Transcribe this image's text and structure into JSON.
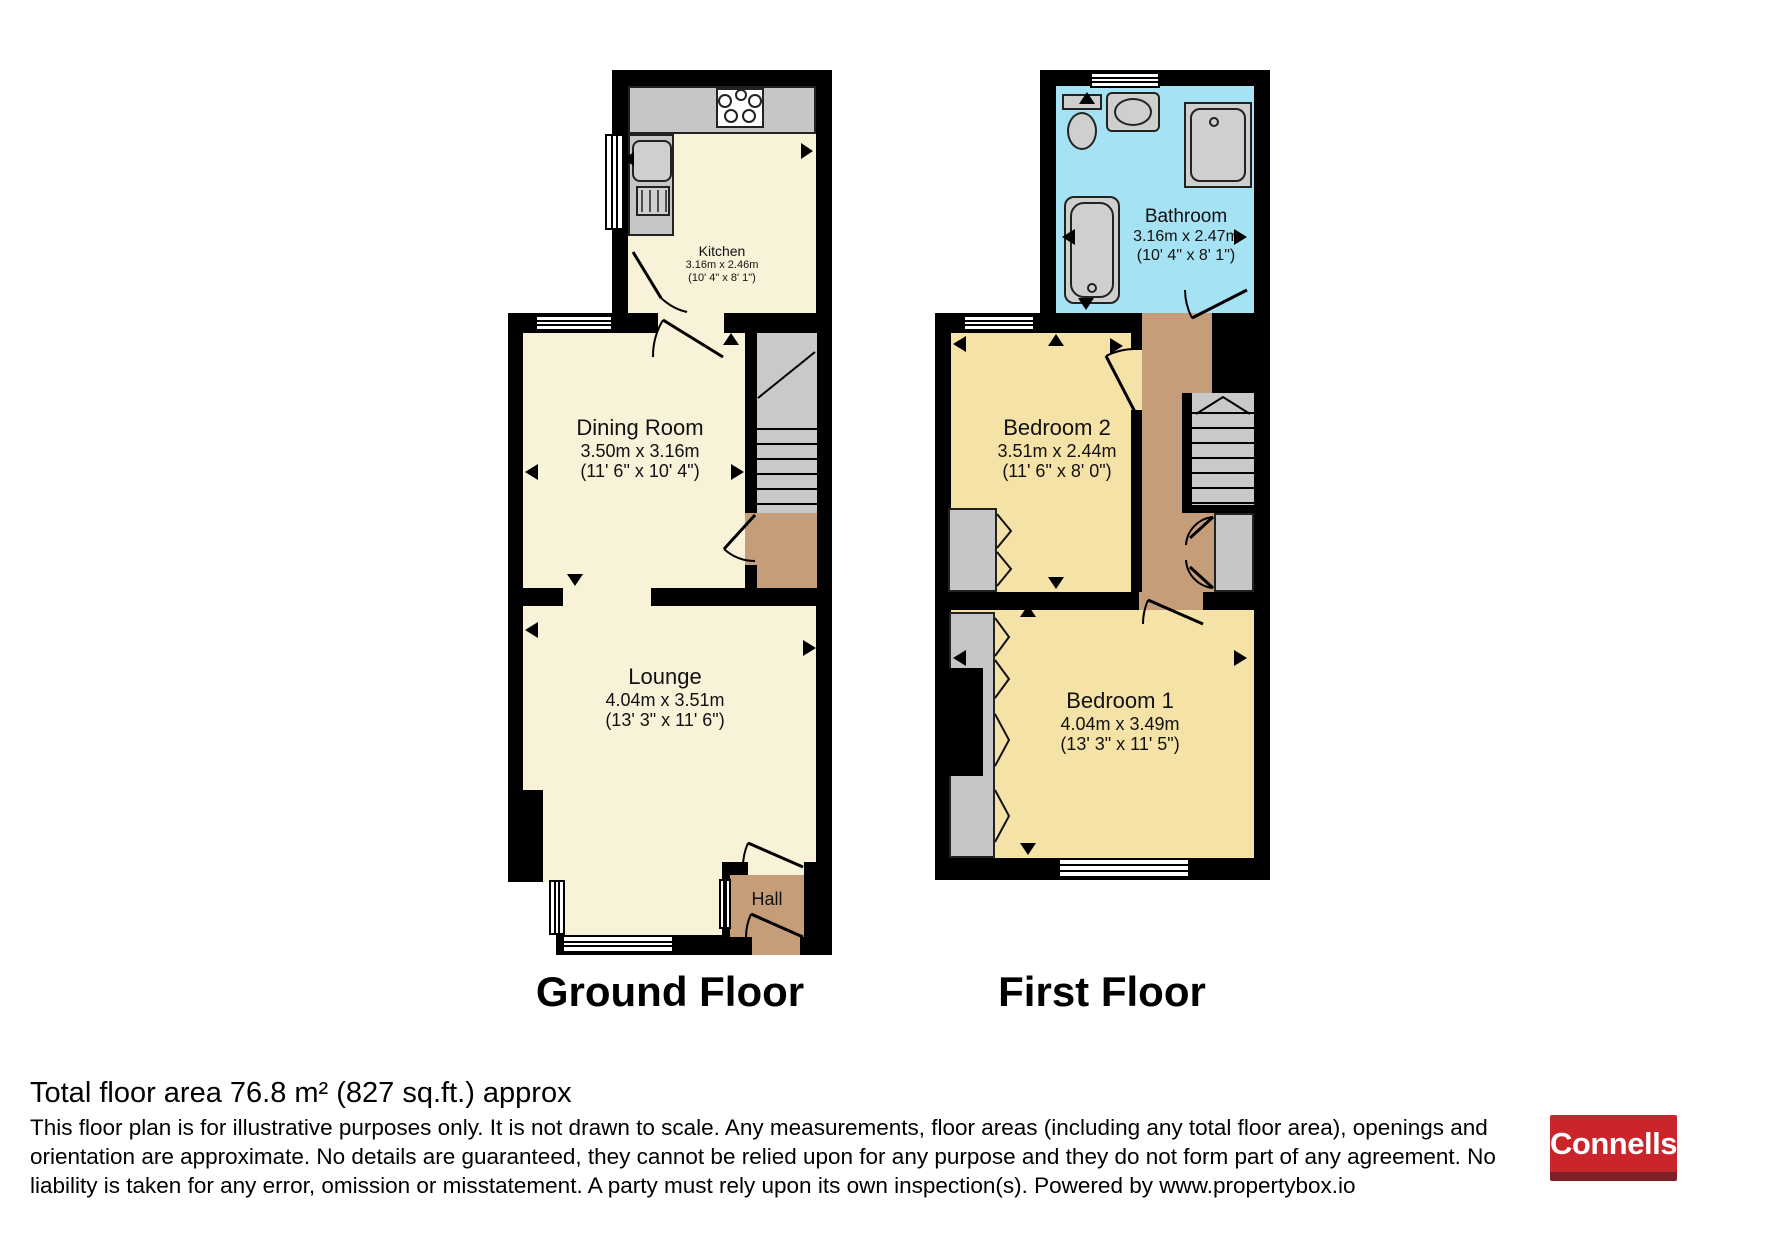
{
  "floor_labels": {
    "ground": "Ground Floor",
    "first": "First Floor"
  },
  "rooms": {
    "kitchen": {
      "name": "Kitchen",
      "metric": "3.16m x 2.46m",
      "imperial": "(10' 4\" x 8' 1\")"
    },
    "dining_room": {
      "name": "Dining Room",
      "metric": "3.50m x 3.16m",
      "imperial": "(11' 6\" x 10' 4\")"
    },
    "lounge": {
      "name": "Lounge",
      "metric": "4.04m x 3.51m",
      "imperial": "(13' 3\" x 11' 6\")"
    },
    "hall": {
      "name": "Hall"
    },
    "bathroom": {
      "name": "Bathroom",
      "metric": "3.16m x 2.47m",
      "imperial": "(10' 4\" x 8' 1\")"
    },
    "bedroom2": {
      "name": "Bedroom 2",
      "metric": "3.51m x 2.44m",
      "imperial": "(11' 6\" x 8' 0\")"
    },
    "bedroom1": {
      "name": "Bedroom 1",
      "metric": "4.04m x 3.49m",
      "imperial": "(13' 3\" x 11' 5\")"
    }
  },
  "footer": {
    "total_area": "Total floor area 76.8 m² (827 sq.ft.) approx",
    "disclaimer": [
      "This floor plan is for illustrative purposes only. It is not drawn to scale. Any measurements, floor areas (including any total floor area), openings and",
      "orientation are approximate. No details are guaranteed, they cannot be relied upon for any purpose and they do not form part of any agreement. No",
      "liability is taken for any error, omission or misstatement. A party must rely upon its own inspection(s). Powered by www.propertybox.io"
    ]
  },
  "brand": {
    "name": "Connells",
    "red": "#c9252b",
    "dark_red": "#7d2027"
  },
  "palette": {
    "wall": "#000000",
    "ground_floor_rooms": "#f7f2d8",
    "bedrooms": "#f5e2a6",
    "bathroom": "#a5e2f3",
    "hall_landing": "#c59e79",
    "fixtures_stairs": "#c6c6c6"
  }
}
